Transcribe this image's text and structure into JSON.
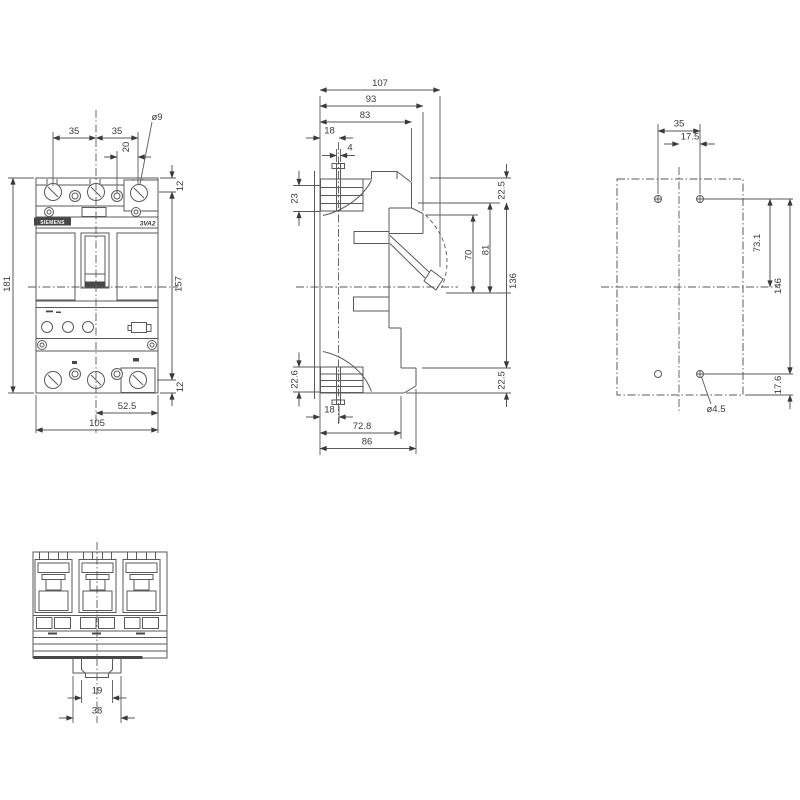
{
  "front_view": {
    "brand": "SIEMENS",
    "model": "3VA2",
    "pole_pitch_left": "35",
    "pole_pitch_right": "35",
    "aux_offset": "20",
    "terminal_hole_dia": "ø9",
    "top_hole_offset": "12",
    "inner_height": "157",
    "bottom_hole_offset": "12",
    "total_height": "181",
    "half_width": "52.5",
    "total_width": "105"
  },
  "side_view": {
    "total_depth": "107",
    "depth_93": "93",
    "depth_83": "83",
    "screw_offset_top": "18",
    "screw_slot": "4",
    "terminal_height_top": "23",
    "top_margin": "22.5",
    "handle_depth_81": "81",
    "handle_depth_70": "70",
    "mid_height": "136",
    "bottom_margin": "22.5",
    "terminal_height_bottom": "22.6",
    "screw_offset_bottom": "18",
    "depth_72_8": "72.8",
    "depth_86": "86"
  },
  "rear_view": {
    "hole_pitch": "35",
    "hole_half_pitch": "17.5",
    "hole_to_center": "73.1",
    "hole_pitch_vertical": "146",
    "hole_to_edge": "17.6",
    "hole_dia": "ø4.5"
  },
  "top_view": {
    "din_slot_width": "19",
    "din_tab_width": "38"
  }
}
